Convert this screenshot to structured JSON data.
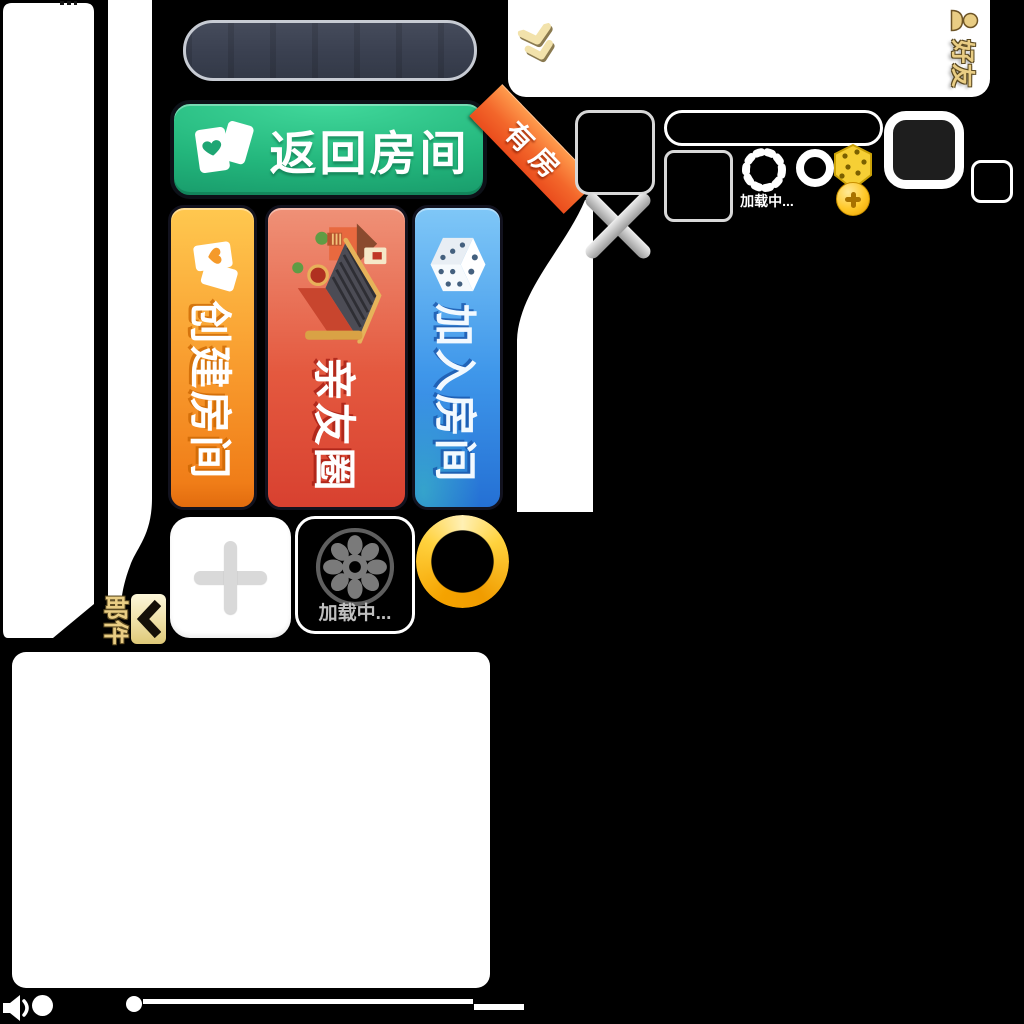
{
  "colors": {
    "background": "#000000",
    "green_button_top": "#41d89b",
    "green_button_bottom": "#169567",
    "ribbon_orange": "#f3672b",
    "orange_banner": "#f89a2d",
    "red_banner": "#e4593f",
    "blue_banner": "#3f97ea",
    "gold_text": "#e9cd84",
    "gold_ring": "#ffd23e"
  },
  "friends_panel": {
    "tab_label": "好友"
  },
  "actions": {
    "return_room_label": "返回房间",
    "ribbon_label": "有房"
  },
  "banners": [
    {
      "label": "创建房间"
    },
    {
      "label": "亲友圈"
    },
    {
      "label": "加入房间"
    }
  ],
  "tiles": {
    "loading_label": "加载中..."
  },
  "hud": {
    "loading_label": "加载中..."
  },
  "mail": {
    "tab_label": "邮件"
  }
}
